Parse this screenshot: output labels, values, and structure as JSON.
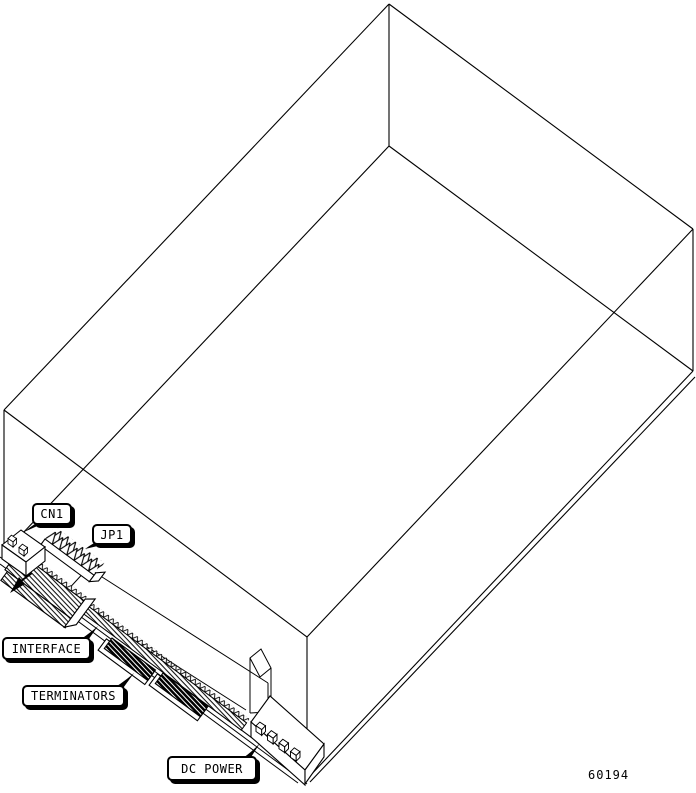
{
  "figure": {
    "part_number": "60194"
  },
  "callouts": [
    {
      "id": "cn1",
      "label": "CN1"
    },
    {
      "id": "jp1",
      "label": "JP1"
    },
    {
      "id": "interface",
      "label": "INTERFACE"
    },
    {
      "id": "terminators",
      "label": "TERMINATORS"
    },
    {
      "id": "dc_power",
      "label": "DC POWER"
    }
  ],
  "colors": {
    "ink": "#000000",
    "paper": "#ffffff"
  }
}
